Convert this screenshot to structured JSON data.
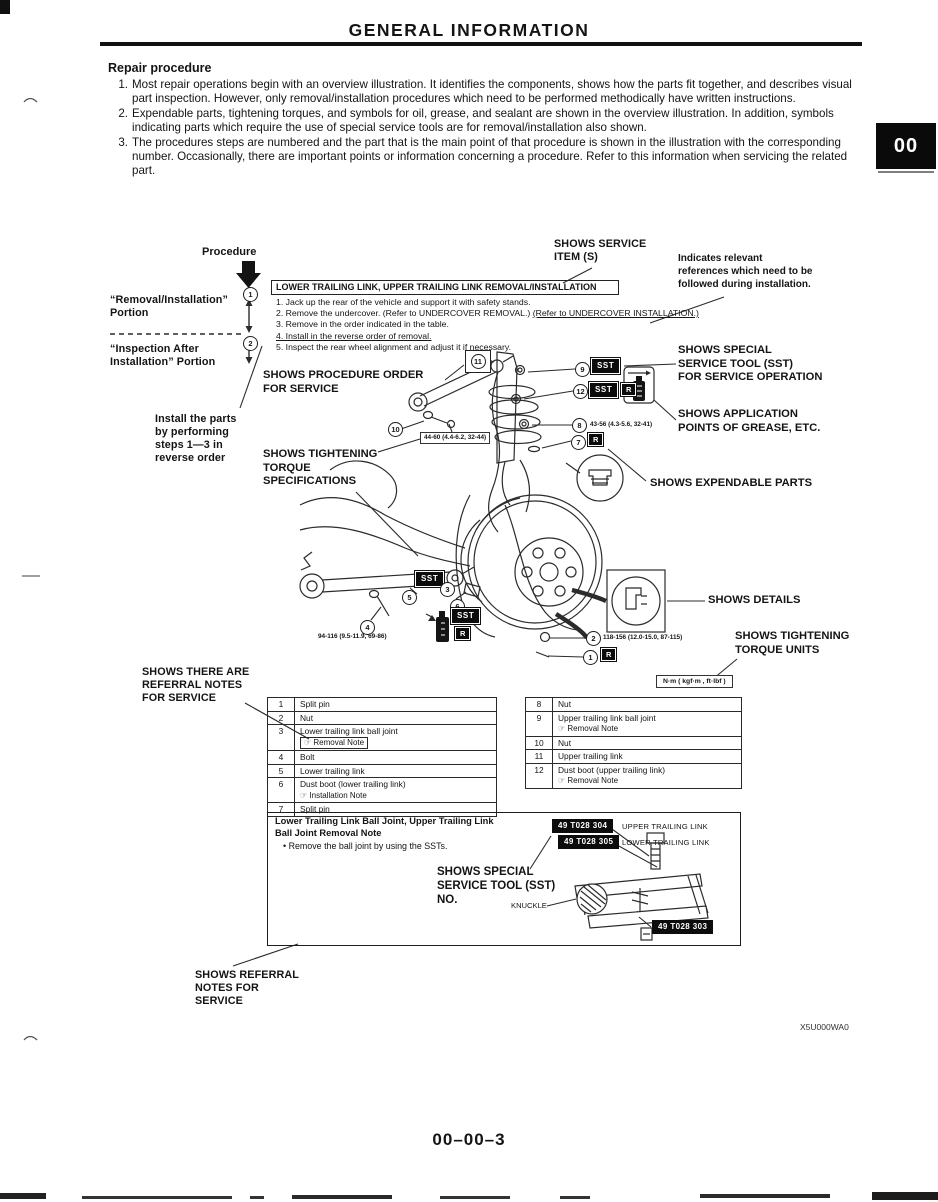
{
  "header": {
    "title": "GENERAL INFORMATION",
    "tab": "00"
  },
  "repair": {
    "heading": "Repair procedure",
    "items": [
      {
        "num": "1.",
        "text": "Most repair operations begin with an overview illustration. It identifies the components, shows how the parts fit together, and describes visual part inspection. However, only removal/installation procedures which need to be performed methodically have written instructions."
      },
      {
        "num": "2.",
        "text": "Expendable parts, tightening torques, and symbols for oil, grease, and sealant are shown in the overview illustration. In addition, symbols indicating parts which require the use of special service tools are for removal/installation also shown."
      },
      {
        "num": "3.",
        "text": "The procedures steps are numbered and the part that is the main point of that procedure is shown in the illustration with the corresponding number. Occasionally, there are important points or information concerning a procedure. Refer to this information when servicing the related part."
      }
    ]
  },
  "figure": {
    "procedure_label": "Procedure",
    "removal_portion": "“Removal/Installation”\nPortion",
    "inspection_portion": "“Inspection After\nInstallation” Portion",
    "title_box": "LOWER TRAILING LINK, UPPER TRAILING LINK REMOVAL/INSTALLATION",
    "steps": [
      {
        "text": "1. Jack up the rear of the vehicle and support it with safety stands.",
        "underlined": ""
      },
      {
        "text": "2. Remove the undercover. (Refer to UNDERCOVER REMOVAL.) ",
        "underlined": "(Refer to UNDERCOVER INSTALLATION.)"
      },
      {
        "text": "3. Remove in the order indicated in the table.",
        "underlined": ""
      },
      {
        "text": "",
        "underlined": "4. Install in the reverse order of removal."
      },
      {
        "text": "5. Inspect the rear wheel alignment and adjust it if necessary.",
        "underlined": ""
      }
    ],
    "labels": {
      "shows_service_item": "SHOWS SERVICE\nITEM (S)",
      "indicates_relevant": "Indicates relevant\nreferences which need to be\nfollowed during installation.",
      "shows_procedure_order": "SHOWS PROCEDURE ORDER\nFOR SERVICE",
      "shows_sst": "SHOWS SPECIAL\nSERVICE TOOL (SST)\nFOR SERVICE OPERATION",
      "shows_application": "SHOWS APPLICATION\nPOINTS OF GREASE, ETC.",
      "install_parts": "Install the parts\nby performing\nsteps 1—3 in\nreverse order",
      "shows_tightening_spec": "SHOWS TIGHTENING\nTORQUE\nSPECIFICATIONS",
      "shows_expendable": "SHOWS EXPENDABLE PARTS",
      "shows_details": "SHOWS DETAILS",
      "shows_torque_units": "SHOWS TIGHTENING\nTORQUE UNITS",
      "shows_referral_table": "SHOWS THERE ARE\nREFERRAL NOTES\nFOR SERVICE",
      "shows_referral_note": "SHOWS REFERRAL\nNOTES FOR\nSERVICE"
    },
    "units_box": "N·m ( kgf·m , ft·lbf )",
    "sst_label": "SST",
    "r_label": "R",
    "torques": {
      "upper_bolt": "44-60 (4.4-6.2, 32-44)",
      "t8": "43-56 (4.3-5.6, 32-41)",
      "t4": "94-116 (9.5-11.9, 69-86)",
      "t2": "118-156 (12.0-15.0, 87-115)"
    },
    "nums": [
      "1",
      "2",
      "3",
      "4",
      "5",
      "6",
      "7",
      "8",
      "9",
      "10",
      "11",
      "12"
    ],
    "tables": {
      "left": [
        {
          "num": "1",
          "name": "Split pin",
          "note": ""
        },
        {
          "num": "2",
          "name": "Nut",
          "note": ""
        },
        {
          "num": "3",
          "name": "Lower trailing link ball joint",
          "note": "☞ Removal Note"
        },
        {
          "num": "4",
          "name": "Bolt",
          "note": ""
        },
        {
          "num": "5",
          "name": "Lower trailing link",
          "note": ""
        },
        {
          "num": "6",
          "name": "Dust boot (lower trailing link)",
          "note": "☞ Installation Note"
        },
        {
          "num": "7",
          "name": "Split pin",
          "note": ""
        }
      ],
      "right": [
        {
          "num": "8",
          "name": "Nut",
          "note": ""
        },
        {
          "num": "9",
          "name": "Upper trailing link ball joint",
          "note": "☞ Removal Note"
        },
        {
          "num": "10",
          "name": "Nut",
          "note": ""
        },
        {
          "num": "11",
          "name": "Upper trailing link",
          "note": ""
        },
        {
          "num": "12",
          "name": "Dust boot (upper trailing link)",
          "note": "☞ Removal Note"
        }
      ]
    },
    "note_box": {
      "title": "Lower Trailing Link Ball Joint, Upper Trailing Link\nBall Joint Removal Note",
      "bullet": "•  Remove the ball joint by using the SSTs.",
      "sst_304": "49 T028 304",
      "sst_304_label": "UPPER TRAILING LINK",
      "sst_305": "49 T028 305",
      "sst_305_label": "LOWER TRAILING LINK",
      "sst_303": "49 T028 303",
      "shows_sst_no": "SHOWS SPECIAL\nSERVICE TOOL (SST)\nNO.",
      "knuckle": "KNUCKLE"
    }
  },
  "footer": {
    "figure_code": "X5U000WA0",
    "page_number": "00–00–3"
  }
}
